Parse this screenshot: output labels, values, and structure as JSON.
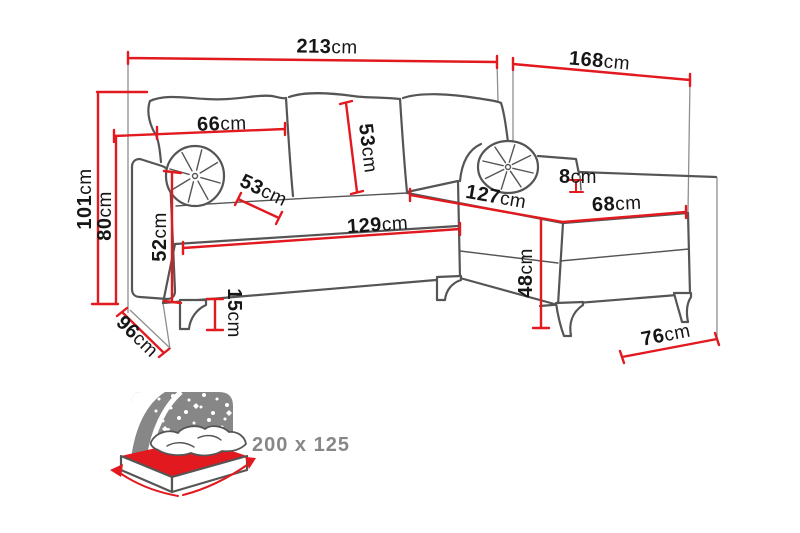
{
  "colors": {
    "dimension-red": "#e2191f",
    "outline-gray": "#555555",
    "ext-gray": "#8f8f8f",
    "label-black": "#161616",
    "icon-gray": "#878787"
  },
  "dims": {
    "total_width": {
      "value": "213",
      "unit": "cm"
    },
    "chaise_total_depth": {
      "value": "168",
      "unit": "cm"
    },
    "back_cushion_width": {
      "value": "66",
      "unit": "cm"
    },
    "back_cushion_height": {
      "value": "53",
      "unit": "cm"
    },
    "seat_depth": {
      "value": "53",
      "unit": "cm"
    },
    "ledge_step": {
      "value": "8",
      "unit": "cm"
    },
    "total_height": {
      "value": "101",
      "unit": "cm"
    },
    "back_height": {
      "value": "80",
      "unit": "cm"
    },
    "armrest_height": {
      "value": "52",
      "unit": "cm"
    },
    "side_depth": {
      "value": "96",
      "unit": "cm"
    },
    "leg_height": {
      "value": "15",
      "unit": "cm"
    },
    "seat_width": {
      "value": "129",
      "unit": "cm"
    },
    "chaise_length": {
      "value": "127",
      "unit": "cm"
    },
    "chaise_seat_width": {
      "value": "68",
      "unit": "cm"
    },
    "seat_height": {
      "value": "48",
      "unit": "cm"
    },
    "chaise_floor_width": {
      "value": "76",
      "unit": "cm"
    }
  },
  "bed_icon": {
    "size_label": "200 x 125"
  }
}
